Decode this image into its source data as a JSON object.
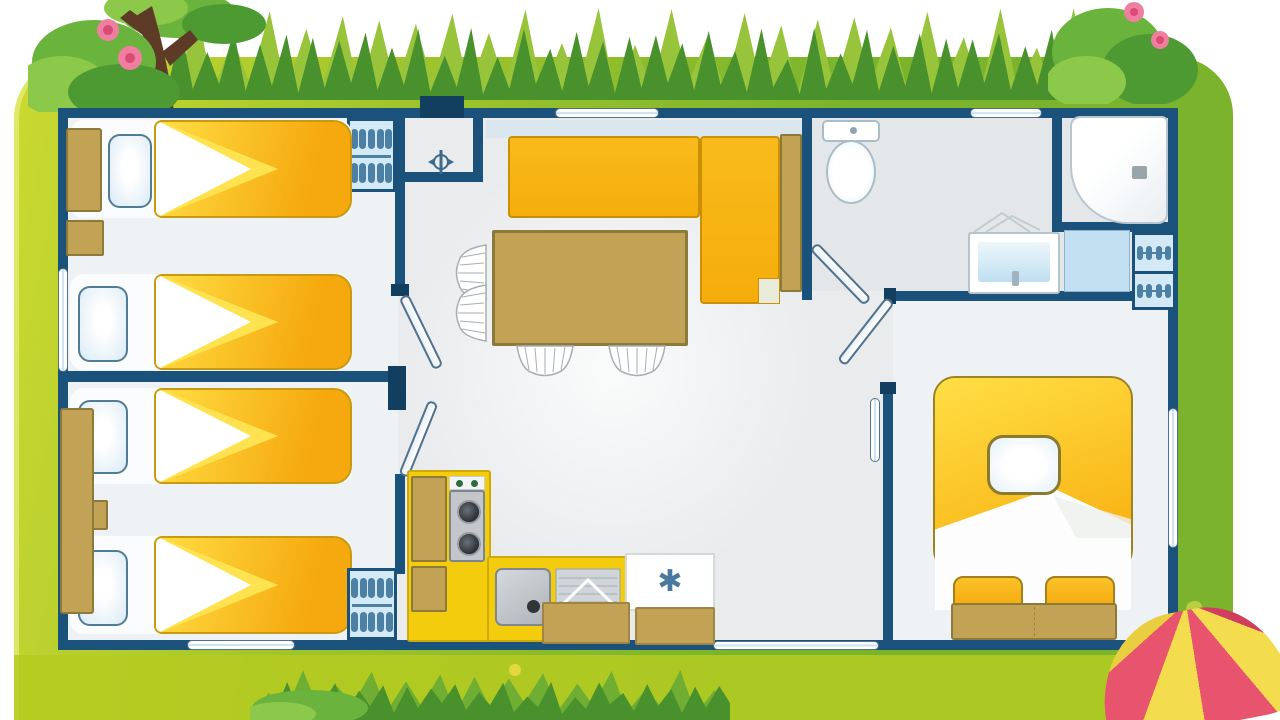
{
  "symbols": {
    "freezer": "✱"
  },
  "colors": {
    "wall": "#1b527c",
    "wallDark": "#123e5f",
    "floor": "#e9ebed",
    "floorBed": "#eef2f4",
    "floorBath": "#e4e7e9",
    "glass": "#cfe4f0",
    "bedYellowLight": "#ffdf45",
    "bedOrange": "#f5a90e",
    "foldYellow": "#ffe250",
    "blanketEdge": "#c89a10",
    "pillow": "#d9eaf4",
    "pillowEdge": "#517c96",
    "tan": "#c2a255",
    "tanDark": "#8b7a3a",
    "sofa": "#f6ad0b",
    "sofaEdge": "#c98f07",
    "sofaNotch": "#e9ecda",
    "wardrobeBg": "#d3e9f5",
    "hanger": "#4d80a5",
    "kitchen": "#f2cc0d",
    "kitchenEdge": "#cfa90a",
    "stove": "#c3c7cb",
    "stoveEdge": "#7d858c",
    "burner": "#2b3036",
    "sink": "#c6cbd0",
    "freezerIcon": "#49799e",
    "fixtureEdge": "#a9bdc9",
    "basinBlue": "#bfdff1",
    "counterBlue": "#c3e0f2",
    "door": "#f2f7fa",
    "doorEdge": "#51718c",
    "frame1": "#ccd930",
    "frame2": "#9fc42c",
    "frame3": "#7bb42c",
    "frameBottom": "#b5cb21",
    "grassDark": "#48912c",
    "grassMid": "#6fae33",
    "grassLight": "#97c43a",
    "trunk": "#5d3b26",
    "leafDark": "#4c9a31",
    "leafMid": "#6ab33d",
    "leafLight": "#8cc84a",
    "flower": "#ef7fa0",
    "flowerDeep": "#d94a74",
    "ballPink": "#e8536e",
    "ballPinkDark": "#d13d5f",
    "ballYellow": "#f3dd4e",
    "ballYellowDark": "#e9cf40"
  }
}
